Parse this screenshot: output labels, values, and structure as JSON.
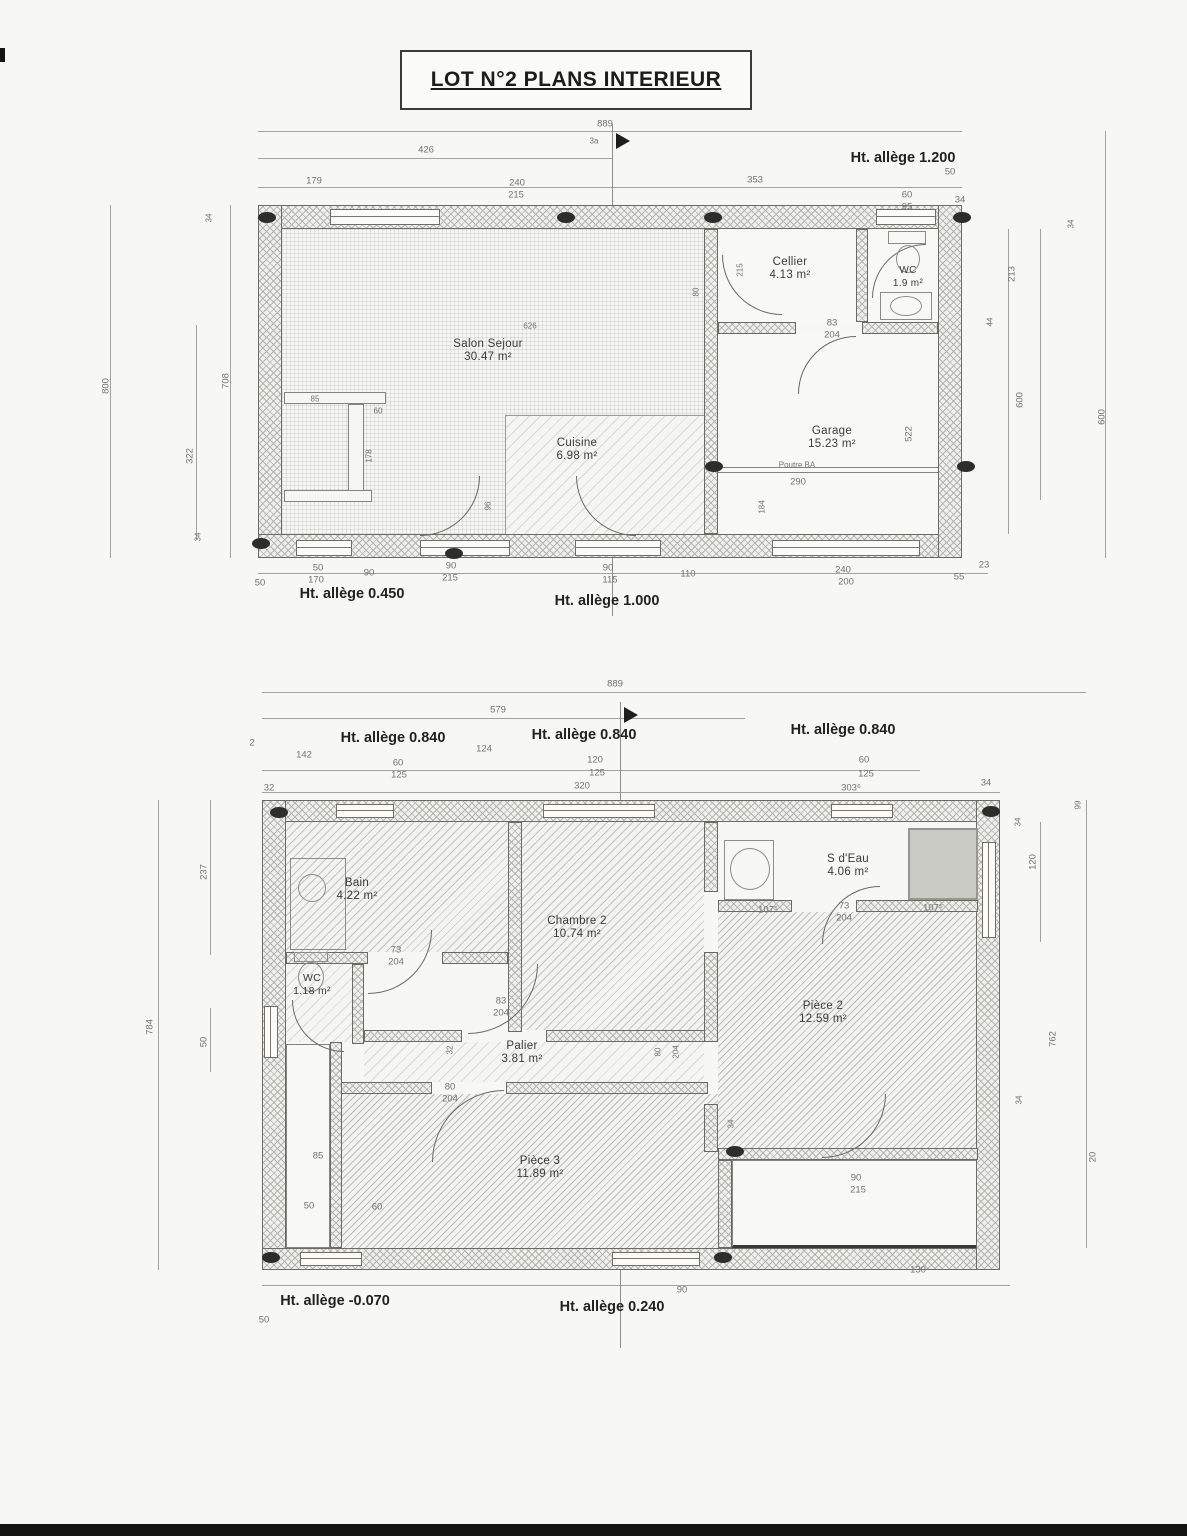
{
  "title": "LOT N°2  PLANS INTERIEUR",
  "colors": {
    "paper": "#f7f7f4",
    "ink": "#22221f",
    "dim_text": "#73726c",
    "wall_hatch": "#b5b5b0"
  },
  "plan1": {
    "rooms": {
      "salon": {
        "name": "Salon Sejour",
        "area": "30.47 m²"
      },
      "cuisine": {
        "name": "Cuisine",
        "area": "6.98 m²"
      },
      "cellier": {
        "name": "Cellier",
        "area": "4.13 m²"
      },
      "wc": {
        "name": "WC",
        "area": "1.9 m²"
      },
      "garage": {
        "name": "Garage",
        "area": "15.23 m²"
      }
    }
  },
  "plan2": {
    "rooms": {
      "bain": {
        "name": "Bain",
        "area": "4.22 m²"
      },
      "wc": {
        "name": "WC",
        "area": "1.18 m²"
      },
      "chambre2": {
        "name": "Chambre 2",
        "area": "10.74 m²"
      },
      "sdeau": {
        "name": "S d'Eau",
        "area": "4.06 m²"
      },
      "piece2": {
        "name": "Pièce 2",
        "area": "12.59 m²"
      },
      "palier": {
        "name": "Palier",
        "area": "3.81 m²"
      },
      "piece3": {
        "name": "Pièce 3",
        "area": "11.89 m²"
      }
    }
  },
  "annotations": [
    {
      "t": "889",
      "x": 605,
      "y": 124
    },
    {
      "t": "3a",
      "x": 594,
      "y": 141,
      "c": "s"
    },
    {
      "t": "426",
      "x": 426,
      "y": 150
    },
    {
      "t": "Ht. allège 1.200",
      "x": 903,
      "y": 158,
      "c": "b"
    },
    {
      "t": "50",
      "x": 950,
      "y": 172
    },
    {
      "t": "179",
      "x": 314,
      "y": 181
    },
    {
      "t": "240",
      "x": 517,
      "y": 183
    },
    {
      "t": "215",
      "x": 516,
      "y": 195
    },
    {
      "t": "353",
      "x": 755,
      "y": 180
    },
    {
      "t": "60",
      "x": 907,
      "y": 195
    },
    {
      "t": "95",
      "x": 907,
      "y": 207
    },
    {
      "t": "34",
      "x": 960,
      "y": 200
    },
    {
      "t": "800",
      "x": 106,
      "y": 386,
      "r": 1
    },
    {
      "t": "708",
      "x": 226,
      "y": 381,
      "r": 1
    },
    {
      "t": "322",
      "x": 190,
      "y": 456,
      "r": 1
    },
    {
      "t": "34",
      "x": 209,
      "y": 218,
      "r": 1,
      "c": "s"
    },
    {
      "t": "34",
      "x": 198,
      "y": 537,
      "r": 1,
      "c": "s"
    },
    {
      "t": "213",
      "x": 1012,
      "y": 274,
      "r": 1
    },
    {
      "t": "44",
      "x": 990,
      "y": 322,
      "r": 1,
      "c": "s"
    },
    {
      "t": "600",
      "x": 1020,
      "y": 400,
      "r": 1
    },
    {
      "t": "34",
      "x": 1071,
      "y": 224,
      "r": 1,
      "c": "s"
    },
    {
      "t": "600",
      "x": 1102,
      "y": 417,
      "r": 1
    },
    {
      "t": "626",
      "x": 530,
      "y": 326,
      "c": "s"
    },
    {
      "t": "215",
      "x": 740,
      "y": 270,
      "r": 1,
      "c": "s"
    },
    {
      "t": "80",
      "x": 696,
      "y": 292,
      "r": 1,
      "c": "s"
    },
    {
      "t": "83",
      "x": 832,
      "y": 323
    },
    {
      "t": "204",
      "x": 832,
      "y": 335
    },
    {
      "t": "85",
      "x": 315,
      "y": 399,
      "c": "s"
    },
    {
      "t": "60",
      "x": 378,
      "y": 411,
      "c": "s"
    },
    {
      "t": "178",
      "x": 369,
      "y": 456,
      "r": 1,
      "c": "s"
    },
    {
      "t": "96",
      "x": 488,
      "y": 506,
      "r": 1,
      "c": "s"
    },
    {
      "t": "522",
      "x": 909,
      "y": 434,
      "r": 1
    },
    {
      "t": "184",
      "x": 762,
      "y": 507,
      "r": 1,
      "c": "s"
    },
    {
      "t": "Poutre BA",
      "x": 797,
      "y": 465,
      "c": "s"
    },
    {
      "t": "290",
      "x": 798,
      "y": 482
    },
    {
      "t": "50",
      "x": 260,
      "y": 583
    },
    {
      "t": "50",
      "x": 318,
      "y": 568
    },
    {
      "t": "170",
      "x": 316,
      "y": 580
    },
    {
      "t": "90",
      "x": 369,
      "y": 573
    },
    {
      "t": "90",
      "x": 451,
      "y": 566
    },
    {
      "t": "215",
      "x": 450,
      "y": 578
    },
    {
      "t": "90",
      "x": 608,
      "y": 568
    },
    {
      "t": "115",
      "x": 610,
      "y": 580
    },
    {
      "t": "110",
      "x": 688,
      "y": 574
    },
    {
      "t": "240",
      "x": 843,
      "y": 570
    },
    {
      "t": "200",
      "x": 846,
      "y": 582
    },
    {
      "t": "55",
      "x": 959,
      "y": 577
    },
    {
      "t": "23",
      "x": 984,
      "y": 565
    },
    {
      "t": "Ht. allège 0.450",
      "x": 352,
      "y": 594,
      "c": "b"
    },
    {
      "t": "Ht. allège 1.000",
      "x": 607,
      "y": 601,
      "c": "b"
    },
    {
      "t": "889",
      "x": 615,
      "y": 684
    },
    {
      "t": "579",
      "x": 498,
      "y": 710
    },
    {
      "t": "2",
      "x": 252,
      "y": 743
    },
    {
      "t": "Ht. allège 0.840",
      "x": 393,
      "y": 738,
      "c": "b"
    },
    {
      "t": "Ht. allège 0.840",
      "x": 584,
      "y": 735,
      "c": "b"
    },
    {
      "t": "Ht. allège 0.840",
      "x": 843,
      "y": 730,
      "c": "b"
    },
    {
      "t": "142",
      "x": 304,
      "y": 755
    },
    {
      "t": "124",
      "x": 484,
      "y": 749
    },
    {
      "t": "60",
      "x": 398,
      "y": 763
    },
    {
      "t": "125",
      "x": 399,
      "y": 775
    },
    {
      "t": "120",
      "x": 595,
      "y": 760
    },
    {
      "t": "125",
      "x": 597,
      "y": 773
    },
    {
      "t": "60",
      "x": 864,
      "y": 760
    },
    {
      "t": "125",
      "x": 866,
      "y": 774
    },
    {
      "t": "32",
      "x": 269,
      "y": 788
    },
    {
      "t": "320",
      "x": 582,
      "y": 786
    },
    {
      "t": "303⁶",
      "x": 851,
      "y": 788
    },
    {
      "t": "34",
      "x": 986,
      "y": 783
    },
    {
      "t": "237",
      "x": 204,
      "y": 872,
      "r": 1
    },
    {
      "t": "784",
      "x": 150,
      "y": 1027,
      "r": 1
    },
    {
      "t": "50",
      "x": 204,
      "y": 1042,
      "r": 1
    },
    {
      "t": "99",
      "x": 1078,
      "y": 805,
      "r": 1,
      "c": "s"
    },
    {
      "t": "34",
      "x": 1018,
      "y": 822,
      "r": 1,
      "c": "s"
    },
    {
      "t": "120",
      "x": 1033,
      "y": 862,
      "r": 1
    },
    {
      "t": "762",
      "x": 1053,
      "y": 1039,
      "r": 1
    },
    {
      "t": "34",
      "x": 1019,
      "y": 1100,
      "r": 1,
      "c": "s"
    },
    {
      "t": "20",
      "x": 1093,
      "y": 1157,
      "r": 1
    },
    {
      "t": "73",
      "x": 396,
      "y": 950
    },
    {
      "t": "204",
      "x": 396,
      "y": 962
    },
    {
      "t": "83",
      "x": 501,
      "y": 1001
    },
    {
      "t": "204",
      "x": 501,
      "y": 1013
    },
    {
      "t": "73",
      "x": 844,
      "y": 906
    },
    {
      "t": "204",
      "x": 844,
      "y": 918
    },
    {
      "t": "107⁵",
      "x": 768,
      "y": 910
    },
    {
      "t": "107⁵",
      "x": 933,
      "y": 908
    },
    {
      "t": "32",
      "x": 450,
      "y": 1050,
      "r": 1,
      "c": "s"
    },
    {
      "t": "80",
      "x": 658,
      "y": 1052,
      "r": 1,
      "c": "s"
    },
    {
      "t": "204",
      "x": 676,
      "y": 1052,
      "r": 1,
      "c": "s"
    },
    {
      "t": "80",
      "x": 450,
      "y": 1087
    },
    {
      "t": "204",
      "x": 450,
      "y": 1099
    },
    {
      "t": "85",
      "x": 318,
      "y": 1156
    },
    {
      "t": "50",
      "x": 309,
      "y": 1206
    },
    {
      "t": "60",
      "x": 377,
      "y": 1207
    },
    {
      "t": "34",
      "x": 731,
      "y": 1124,
      "r": 1,
      "c": "s"
    },
    {
      "t": "90",
      "x": 856,
      "y": 1178
    },
    {
      "t": "215",
      "x": 858,
      "y": 1190
    },
    {
      "t": "130",
      "x": 918,
      "y": 1270
    },
    {
      "t": "90",
      "x": 682,
      "y": 1290
    },
    {
      "t": "Ht. allège -0.070",
      "x": 335,
      "y": 1301,
      "c": "b"
    },
    {
      "t": "Ht. allège 0.240",
      "x": 612,
      "y": 1307,
      "c": "b"
    },
    {
      "t": "50",
      "x": 264,
      "y": 1320
    }
  ]
}
